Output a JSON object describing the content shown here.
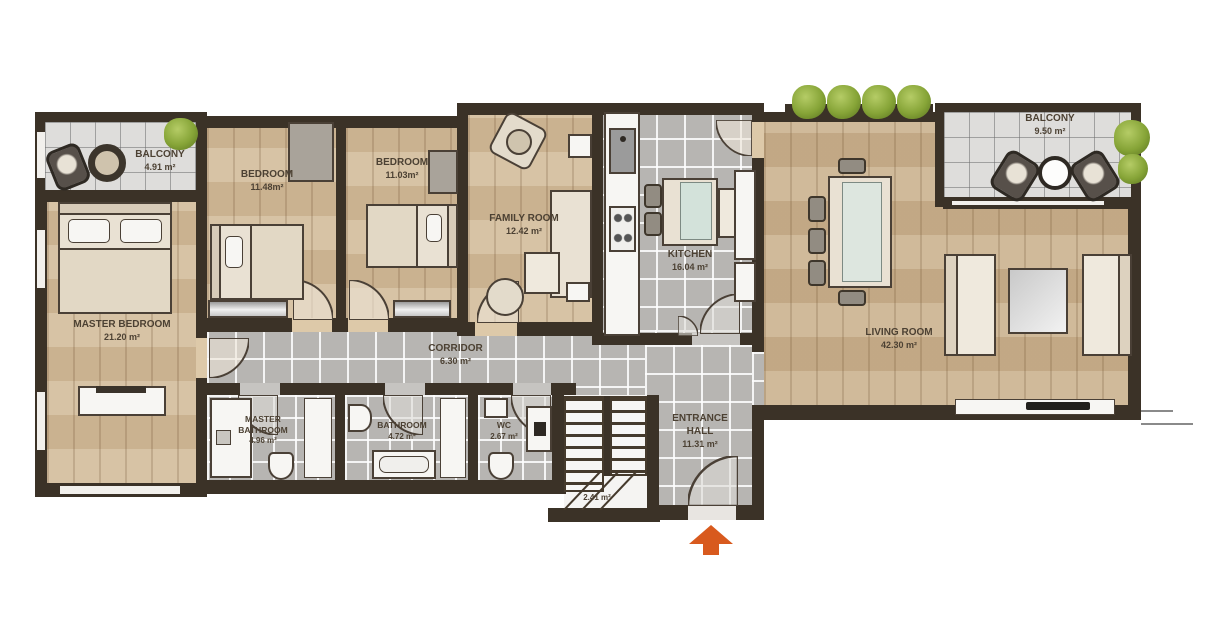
{
  "plan": {
    "title": "apartment-floor-plan",
    "rooms": {
      "balcony_left": {
        "name": "BALCONY",
        "area": "4.91 m²"
      },
      "master_bedroom": {
        "name": "MASTER BEDROOM",
        "area": "21.20 m²"
      },
      "bedroom_1": {
        "name": "BEDROOM",
        "area": "11.48m²"
      },
      "bedroom_2": {
        "name": "BEDROOM",
        "area": "11.03m²"
      },
      "family_room": {
        "name": "FAMILY ROOM",
        "area": "12.42 m²"
      },
      "kitchen": {
        "name": "KITCHEN",
        "area": "16.04 m²"
      },
      "living_room": {
        "name": "LIVING ROOM",
        "area": "42.30 m²"
      },
      "balcony_right": {
        "name": "BALCONY",
        "area": "9.50 m²"
      },
      "corridor": {
        "name": "CORRIDOR",
        "area": "6.30 m²"
      },
      "master_bathroom": {
        "name": "MASTER BATHROOM",
        "area": "4.96 m²"
      },
      "bathroom": {
        "name": "BATHROOM",
        "area": "4.72 m²"
      },
      "wc": {
        "name": "WC",
        "area": "2.67 m²"
      },
      "entrance_hall": {
        "name": "ENTRANCE HALL",
        "area": "11.31 m²"
      },
      "staircase": {
        "area": "2.41 m²"
      }
    },
    "colors": {
      "wall": "#3b3227",
      "wood_floor": "#cbb28f",
      "tile_floor": "#b7b5b2",
      "balcony_floor": "#dedddb",
      "entrance_arrow": "#d85a1e",
      "plant": "#86a437",
      "label_text": "#4c4133"
    }
  }
}
